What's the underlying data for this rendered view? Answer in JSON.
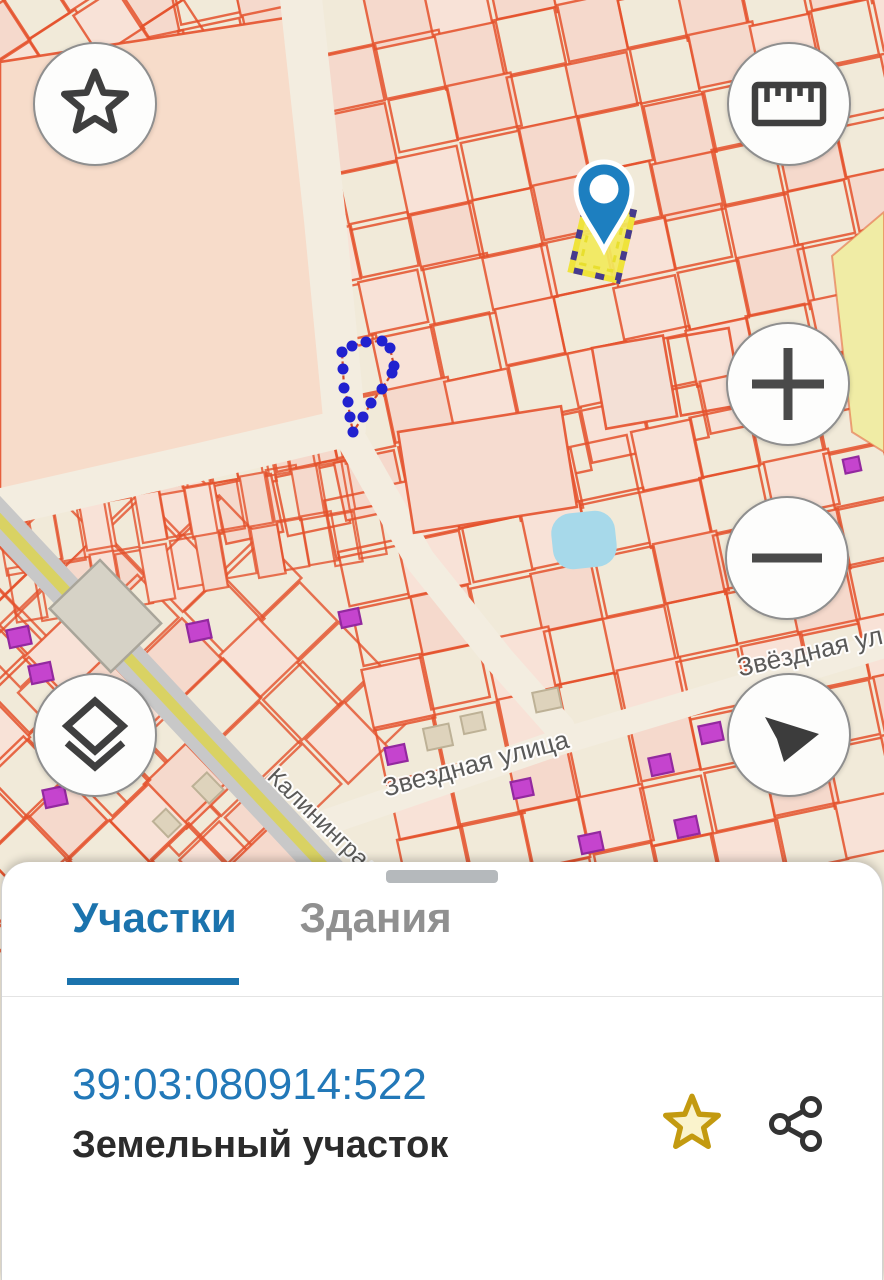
{
  "app": {
    "type": "cadastral-map-viewer"
  },
  "map": {
    "street_labels": [
      {
        "id": "zvezdnaya-center",
        "text": "Звездная улица"
      },
      {
        "id": "zvezdnaya-right",
        "text": "Звёздная ул"
      },
      {
        "id": "kaliningrad-road",
        "text": "Калининградское"
      }
    ],
    "selected_parcel": {
      "highlight_color": "#f2e95c"
    },
    "marker_color": "#1d7fc0",
    "measure_polygon_color": "#2121cf",
    "parcel_line_color": "#e4512c",
    "background_color": "#f1ead9",
    "pond_color": "#a7d9ea",
    "zone_colors": {
      "residential_pink": "#f7dcca",
      "yellow_zone": "#f0eca5"
    }
  },
  "map_controls": [
    {
      "name": "favorites",
      "icon": "star-icon"
    },
    {
      "name": "measure",
      "icon": "ruler-icon"
    },
    {
      "name": "zoom-in",
      "icon": "plus-icon"
    },
    {
      "name": "zoom-out",
      "icon": "minus-icon"
    },
    {
      "name": "layers",
      "icon": "layers-icon"
    },
    {
      "name": "compass",
      "icon": "navigation-arrow-icon"
    }
  ],
  "bottom_sheet": {
    "tabs": [
      {
        "label": "Участки",
        "active": true
      },
      {
        "label": "Здания",
        "active": false
      }
    ],
    "parcel": {
      "cadastral_number": "39:03:080914:522",
      "type_label": "Земельный участок"
    },
    "actions": [
      {
        "name": "favorite",
        "icon": "star-icon"
      },
      {
        "name": "share",
        "icon": "share-icon"
      }
    ],
    "accent_color": "#1b73ad"
  }
}
